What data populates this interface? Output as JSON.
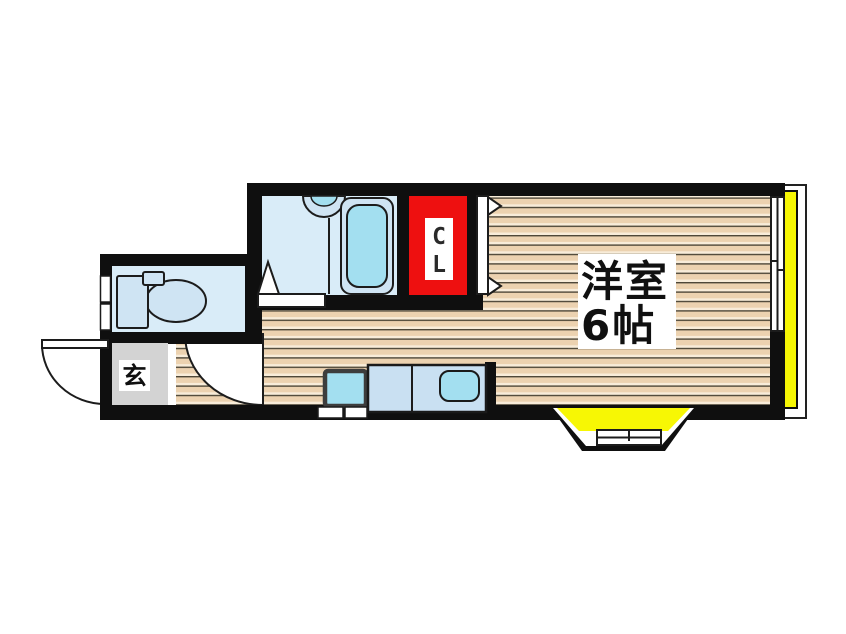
{
  "floorplan": {
    "main_room": {
      "name": "洋室",
      "size": "6帖"
    },
    "closet": {
      "letter_top": "C",
      "letter_bottom": "L"
    },
    "entrance": {
      "label": "玄"
    },
    "colors": {
      "wall_black": "#0f0f0f",
      "closet_red": "#ee1010",
      "balcony_yellow": "#f7f704",
      "genkan_gray": "#d3d3d3",
      "wet_area_blue": "#d9ecf8",
      "fixture_blue": "#cfe4f3",
      "fixture_cyan": "#a3dff0",
      "counter_blue": "#c9e0f2",
      "wood_beige": "#ecd2b0"
    }
  }
}
